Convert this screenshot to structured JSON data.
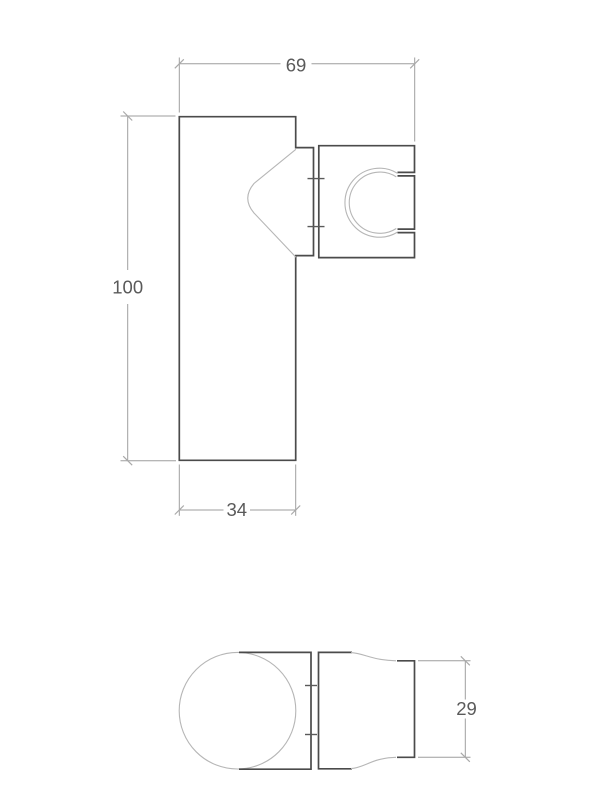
{
  "drawing": {
    "dimensions": {
      "overall_width": "69",
      "body_height": "100",
      "body_width": "34",
      "holder_depth": "29"
    },
    "colors": {
      "part_outline": "#4b4b4b",
      "profile_line": "#b6b6b6",
      "dimension_line": "#9e9e9e",
      "dimension_text": "#5a5a5a",
      "background": "#ffffff"
    }
  }
}
